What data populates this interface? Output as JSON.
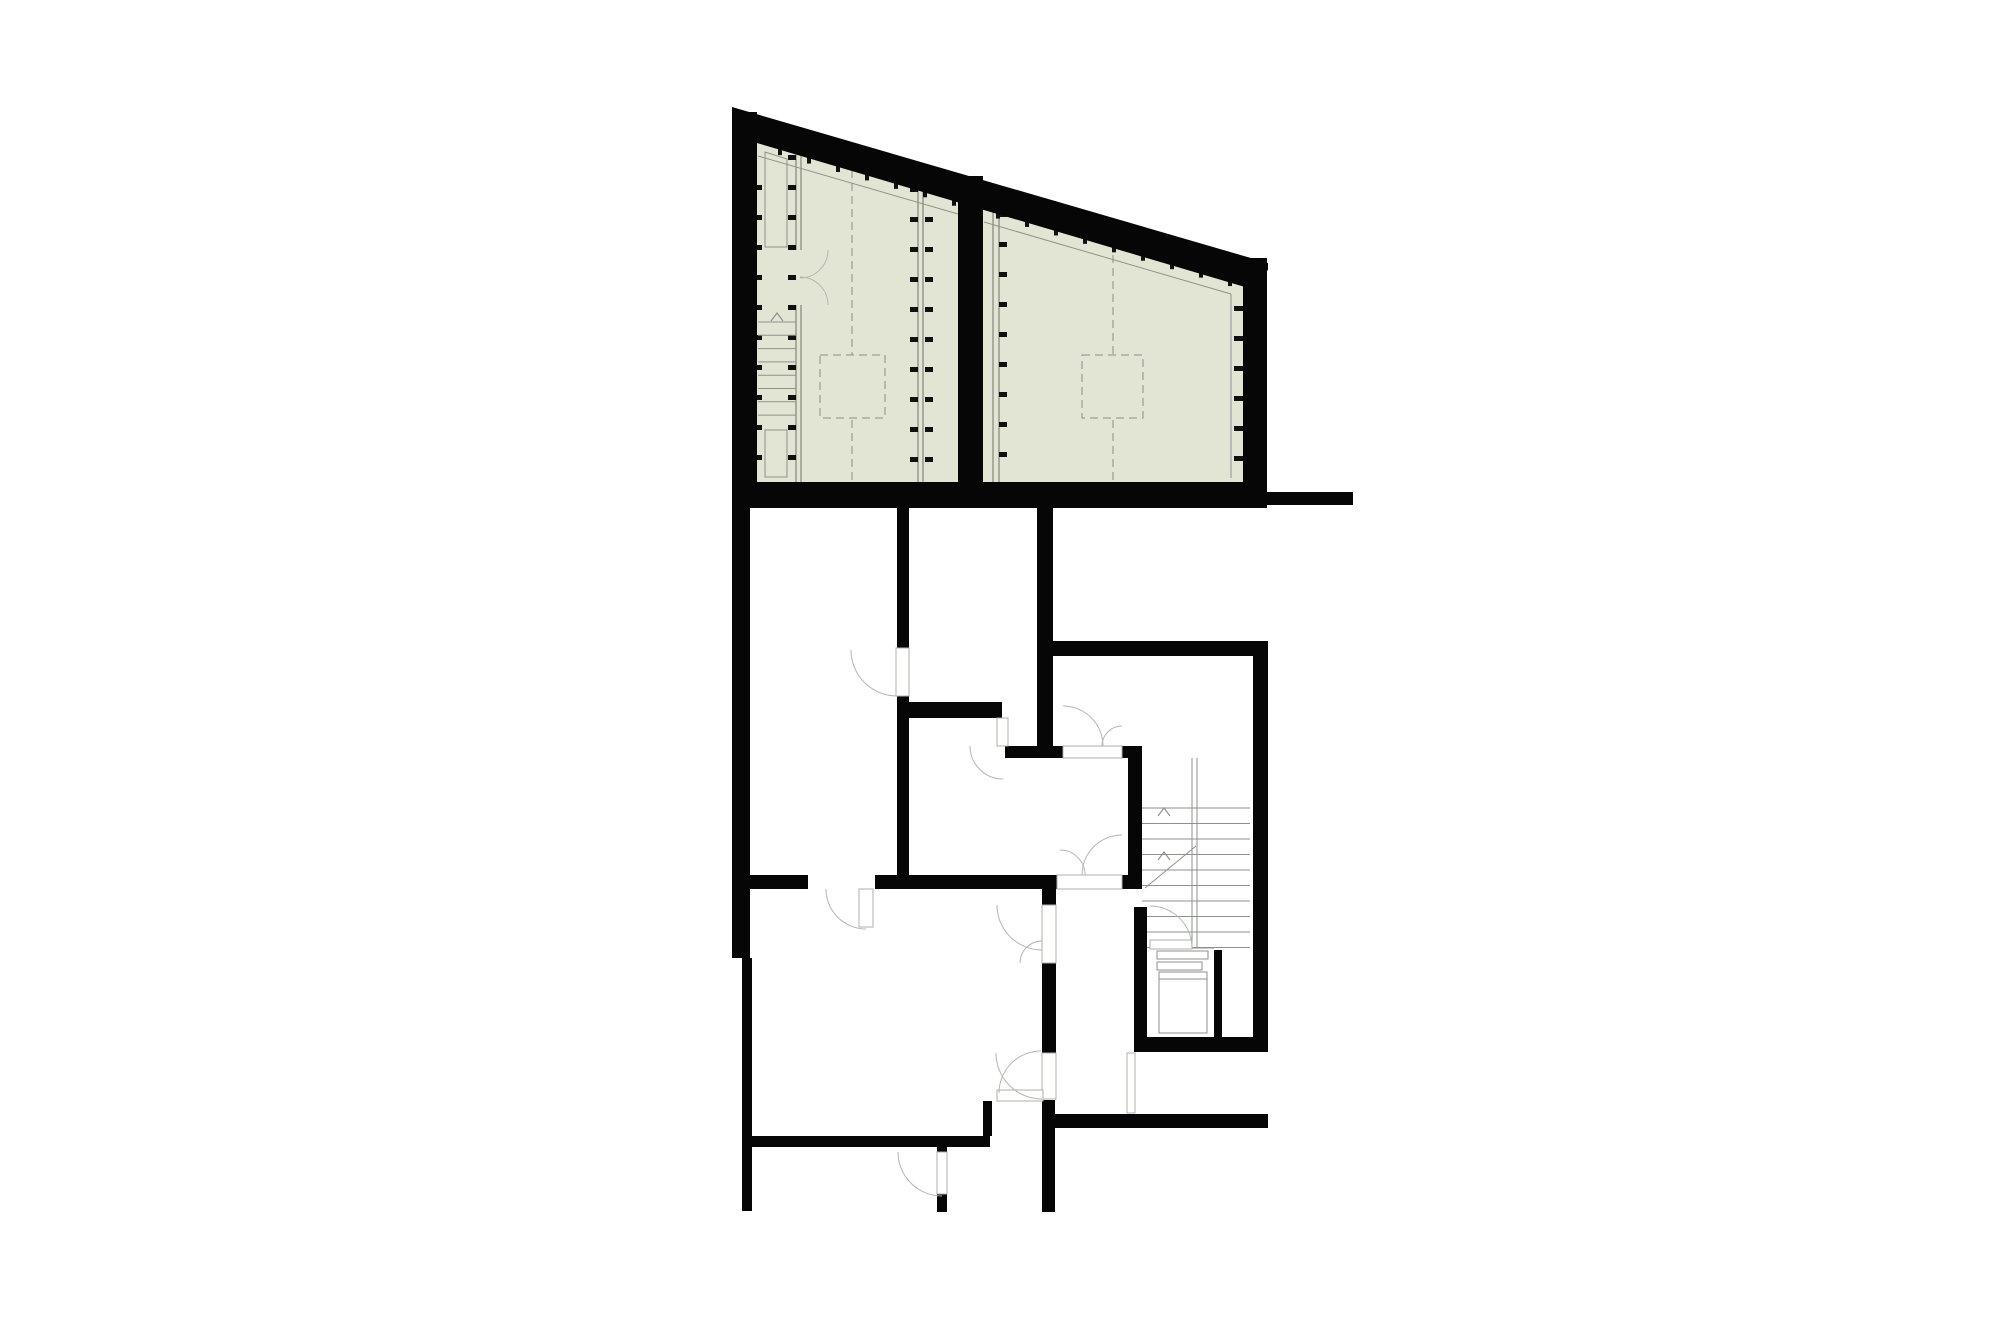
{
  "canvas": {
    "width": 2000,
    "height": 1333,
    "background": "#ffffff"
  },
  "colors": {
    "wall": "#060606",
    "green_fill": "#e3e5d4",
    "thin_line": "#8d928b",
    "dash_line": "#8a8f85",
    "arc_line": "#b3b7af",
    "leaf_stroke": "#adb1a9",
    "leaf_fill": "#ffffff",
    "tick": "#101010"
  },
  "floorplan": {
    "slope_ref": {
      "baseX": 757,
      "baseY": 139,
      "slope": 0.291
    },
    "green_areas": [
      {
        "name": "green-roof-terrace-west",
        "points": "757,140 958,198 958,482 757,482"
      },
      {
        "name": "green-roof-terrace-east",
        "points": "983,206 1243,282 1243,482 983,482"
      }
    ],
    "slope_band": {
      "name": "sloped-north-wall",
      "points": "732,107 1268,263 1268,270 1245,287 757,143 732,120"
    },
    "walls": [
      {
        "name": "left-exterior-wall-upper",
        "x": 732,
        "y": 112,
        "w": 25,
        "h": 396
      },
      {
        "name": "green-divider-wall",
        "x": 958,
        "y": 176,
        "w": 25,
        "h": 332
      },
      {
        "name": "right-exterior-wall-green",
        "x": 1243,
        "y": 258,
        "w": 24,
        "h": 250
      },
      {
        "name": "green-base-wall",
        "x": 732,
        "y": 482,
        "w": 535,
        "h": 26
      },
      {
        "name": "east-extension-wall",
        "x": 1267,
        "y": 492,
        "w": 86,
        "h": 13
      },
      {
        "name": "left-wall-mid",
        "x": 732,
        "y": 508,
        "w": 18,
        "h": 450
      },
      {
        "name": "left-wall-lower",
        "x": 742,
        "y": 958,
        "w": 10,
        "h": 253
      },
      {
        "name": "wall-a-upper",
        "x": 897,
        "y": 508,
        "w": 12,
        "h": 140
      },
      {
        "name": "wall-a-lower",
        "x": 897,
        "y": 696,
        "w": 12,
        "h": 179
      },
      {
        "name": "wall-b",
        "x": 897,
        "y": 702,
        "w": 105,
        "h": 16
      },
      {
        "name": "wall-c-west",
        "x": 1005,
        "y": 746,
        "w": 58,
        "h": 12
      },
      {
        "name": "wall-c-east",
        "x": 1122,
        "y": 746,
        "w": 20,
        "h": 12
      },
      {
        "name": "wall-d",
        "x": 1043,
        "y": 641,
        "w": 225,
        "h": 15
      },
      {
        "name": "wall-e",
        "x": 1037,
        "y": 508,
        "w": 16,
        "h": 250
      },
      {
        "name": "wall-f",
        "x": 1253,
        "y": 643,
        "w": 15,
        "h": 409
      },
      {
        "name": "stairwell-west-wall",
        "x": 1128,
        "y": 758,
        "w": 14,
        "h": 117
      },
      {
        "name": "wall-g-west",
        "x": 744,
        "y": 875,
        "w": 64,
        "h": 14
      },
      {
        "name": "wall-g-mid",
        "x": 875,
        "y": 875,
        "w": 182,
        "h": 14
      },
      {
        "name": "wall-g-east",
        "x": 1122,
        "y": 875,
        "w": 20,
        "h": 14
      },
      {
        "name": "wall-h-upper",
        "x": 1042,
        "y": 889,
        "w": 14,
        "h": 16
      },
      {
        "name": "wall-h-mid",
        "x": 1042,
        "y": 963,
        "w": 14,
        "h": 90
      },
      {
        "name": "wall-h-lower",
        "x": 1042,
        "y": 1100,
        "w": 13,
        "h": 112
      },
      {
        "name": "lower-left-south-wall",
        "x": 750,
        "y": 1136,
        "w": 240,
        "h": 11
      },
      {
        "name": "south-wall-stub",
        "x": 983,
        "y": 1101,
        "w": 9,
        "h": 35
      },
      {
        "name": "door-jamb-upper",
        "x": 937,
        "y": 1146,
        "w": 10,
        "h": 7
      },
      {
        "name": "door-jamb-lower",
        "x": 937,
        "y": 1194,
        "w": 10,
        "h": 18
      },
      {
        "name": "utility-west-wall",
        "x": 1134,
        "y": 907,
        "w": 13,
        "h": 145
      },
      {
        "name": "utility-south-wall",
        "x": 1134,
        "y": 1037,
        "w": 134,
        "h": 15
      },
      {
        "name": "shaft-divider-wall",
        "x": 1214,
        "y": 950,
        "w": 8,
        "h": 87
      },
      {
        "name": "south-east-wall",
        "x": 1053,
        "y": 1114,
        "w": 215,
        "h": 14
      }
    ],
    "partition_lines": [
      [
        796,
        150,
        796,
        250
      ],
      [
        801,
        150,
        801,
        250
      ],
      [
        796,
        305,
        796,
        482
      ],
      [
        801,
        305,
        801,
        482
      ],
      [
        918,
        185,
        918,
        482
      ],
      [
        923,
        185,
        923,
        482
      ],
      [
        993,
        209,
        993,
        482
      ],
      [
        999,
        209,
        999,
        482
      ]
    ],
    "thin_lines": [
      [
        758,
        156,
        958,
        214
      ],
      [
        984,
        222,
        1231,
        294
      ],
      [
        1231,
        294,
        1231,
        478
      ],
      [
        1192,
        758,
        1192,
        947
      ],
      [
        1197,
        758,
        1197,
        947
      ],
      [
        1145,
        888,
        1196,
        846
      ],
      [
        1192,
        948,
        1214,
        948
      ],
      [
        1159,
        979,
        1207,
        979
      ]
    ],
    "thin_polys": [
      {
        "name": "green-room-closet",
        "points": "765,152 787,159 787,247 765,247"
      }
    ],
    "thin_rects": [
      {
        "name": "green-stair-rail",
        "x": 765,
        "y": 430,
        "w": 22,
        "h": 47
      },
      {
        "name": "utility-counter-a",
        "x": 1157,
        "y": 951,
        "w": 51,
        "h": 8
      },
      {
        "name": "utility-counter-b",
        "x": 1157,
        "y": 962,
        "w": 45,
        "h": 8
      },
      {
        "name": "washer-appliance",
        "x": 1159,
        "y": 972,
        "w": 48,
        "h": 61
      }
    ],
    "dashed_lines": [
      [
        852,
        170,
        852,
        355
      ],
      [
        852,
        420,
        852,
        482
      ],
      [
        1113,
        242,
        1113,
        355
      ],
      [
        1113,
        420,
        1113,
        482
      ]
    ],
    "dashed_rects": [
      {
        "name": "skylight-west",
        "x": 820,
        "y": 355,
        "w": 65,
        "h": 63
      },
      {
        "name": "skylight-east",
        "x": 1082,
        "y": 355,
        "w": 61,
        "h": 63
      }
    ],
    "ticks": [
      {
        "name": "room1-west-ticks",
        "x": 753,
        "y": 185,
        "w": 9,
        "h": 5,
        "dx": 0,
        "dy": 30,
        "n": 10
      },
      {
        "name": "room1-p1-ticks",
        "x": 788,
        "y": 155,
        "w": 8,
        "h": 5,
        "dx": 0,
        "dy": 30,
        "n": 11
      },
      {
        "name": "room1-p2-ticks-west",
        "x": 910,
        "y": 187,
        "w": 8,
        "h": 5,
        "dx": 0,
        "dy": 30,
        "n": 10
      },
      {
        "name": "room1-p2-ticks-east",
        "x": 925,
        "y": 187,
        "w": 8,
        "h": 5,
        "dx": 0,
        "dy": 30,
        "n": 10
      },
      {
        "name": "room2-p3-ticks",
        "x": 999,
        "y": 212,
        "w": 8,
        "h": 5,
        "dx": 0,
        "dy": 30,
        "n": 9
      },
      {
        "name": "room2-east-ticks",
        "x": 1234,
        "y": 306,
        "w": 9,
        "h": 5,
        "dx": 0,
        "dy": 30,
        "n": 6
      },
      {
        "name": "room1-south-ticks",
        "x": 760,
        "y": 483,
        "w": 5,
        "h": 9,
        "dx": 29,
        "dy": 0,
        "n": 7
      },
      {
        "name": "room2-south-ticks",
        "x": 1000,
        "y": 483,
        "w": 5,
        "h": 9,
        "dx": 29,
        "dy": 0,
        "n": 9
      }
    ],
    "slope_ticks": [
      {
        "name": "room1-slope-ticks",
        "x0": 778,
        "dx": 29,
        "n": 7,
        "w": 4,
        "h": 12
      },
      {
        "name": "room2-slope-ticks",
        "x0": 996,
        "dx": 29,
        "n": 9,
        "w": 4,
        "h": 12
      }
    ],
    "stairs": [
      {
        "name": "green-roof-stair",
        "x1": 758,
        "x2": 796,
        "y0": 322,
        "dy": 13.3,
        "n": 8
      },
      {
        "name": "main-stairwell",
        "x1": 1142,
        "x2": 1250,
        "y0": 808,
        "dy": 15.5,
        "n": 10
      }
    ],
    "chevrons": [
      {
        "name": "green-stair-direction-arrow",
        "x": 777,
        "y": 313
      },
      {
        "name": "stairwell-direction-arrow-a",
        "x": 1164,
        "y": 808
      },
      {
        "name": "stairwell-direction-arrow-b",
        "x": 1164,
        "y": 852
      }
    ],
    "doors": [
      {
        "name": "green-terrace-double-door-upper",
        "arc": {
          "sx": 828,
          "sy": 250,
          "ex": 800,
          "ey": 278,
          "r": 28,
          "sweep": 1
        }
      },
      {
        "name": "green-terrace-double-door-lower",
        "arc": {
          "sx": 828,
          "sy": 305,
          "ex": 800,
          "ey": 277,
          "r": 28,
          "sweep": 0
        }
      },
      {
        "name": "door-west-room",
        "leaf": {
          "x": 896,
          "y": 648,
          "w": 13,
          "h": 48
        },
        "arc": {
          "sx": 851,
          "sy": 650,
          "ex": 897,
          "ey": 696,
          "r": 46,
          "sweep": 0
        }
      },
      {
        "name": "door-southwest-room",
        "leaf": {
          "x": 859,
          "y": 889,
          "w": 14,
          "h": 38
        },
        "arc": {
          "sx": 826,
          "sy": 889,
          "ex": 866,
          "ey": 929,
          "r": 40,
          "sweep": 0
        }
      },
      {
        "name": "hall-north-double-door-west-leaf",
        "leaf": {
          "x": 1063,
          "y": 746,
          "w": 59,
          "h": 12
        },
        "arc": {
          "sx": 1063,
          "sy": 706,
          "ex": 1103,
          "ey": 746,
          "r": 40,
          "sweep": 1
        }
      },
      {
        "name": "hall-north-double-door-east-leaf",
        "arc": {
          "sx": 1122,
          "sy": 726,
          "ex": 1102,
          "ey": 746,
          "r": 20,
          "sweep": 0
        }
      },
      {
        "name": "hall-south-double-door-west-leaf",
        "leaf": {
          "x": 1057,
          "y": 875,
          "w": 65,
          "h": 14
        },
        "arc": {
          "sx": 1060,
          "sy": 850,
          "ex": 1085,
          "ey": 875,
          "r": 25,
          "sweep": 1
        }
      },
      {
        "name": "hall-south-double-door-east-leaf",
        "arc": {
          "sx": 1122,
          "sy": 835,
          "ex": 1082,
          "ey": 875,
          "r": 40,
          "sweep": 0
        }
      },
      {
        "name": "corridor-door-upper",
        "leaf": {
          "x": 1042,
          "y": 905,
          "w": 14,
          "h": 58
        },
        "arc": {
          "sx": 997,
          "sy": 905,
          "ex": 1042,
          "ey": 950,
          "r": 45,
          "sweep": 0
        }
      },
      {
        "name": "corridor-door-upper-small-leaf",
        "arc": {
          "sx": 1020,
          "sy": 963,
          "ex": 1042,
          "ey": 941,
          "r": 22,
          "sweep": 1
        }
      },
      {
        "name": "corridor-door-lower",
        "leaf": {
          "x": 1042,
          "y": 1053,
          "w": 14,
          "h": 46
        },
        "arc": {
          "sx": 996,
          "sy": 1053,
          "ex": 1042,
          "ey": 1099,
          "r": 46,
          "sweep": 0
        }
      },
      {
        "name": "door-bottom-room",
        "leaf": {
          "x": 937,
          "y": 1152,
          "w": 10,
          "h": 42
        },
        "arc": {
          "sx": 898,
          "sy": 1152,
          "ex": 942,
          "ey": 1196,
          "r": 44,
          "sweep": 0
        }
      },
      {
        "name": "door-bottom-middle",
        "leaf": {
          "x": 997,
          "y": 1090,
          "w": 46,
          "h": 11
        },
        "arc": {
          "sx": 999,
          "sy": 1093,
          "ex": 1041,
          "ey": 1051,
          "r": 42,
          "sweep": 1
        }
      },
      {
        "name": "door-stair-to-utility",
        "leaf": {
          "x": 1150,
          "y": 940,
          "w": 42,
          "h": 9
        },
        "arc": {
          "sx": 1150,
          "sy": 906,
          "ex": 1192,
          "ey": 948,
          "r": 42,
          "sweep": 1
        }
      },
      {
        "name": "door-mid-room",
        "leaf": {
          "x": 997,
          "y": 718,
          "w": 11,
          "h": 28
        },
        "arc": {
          "sx": 970,
          "sy": 746,
          "ex": 1003,
          "ey": 779,
          "r": 33,
          "sweep": 0
        }
      },
      {
        "name": "door-southeast-gap",
        "leaf": {
          "x": 1127,
          "y": 1053,
          "w": 8,
          "h": 60
        }
      }
    ]
  }
}
